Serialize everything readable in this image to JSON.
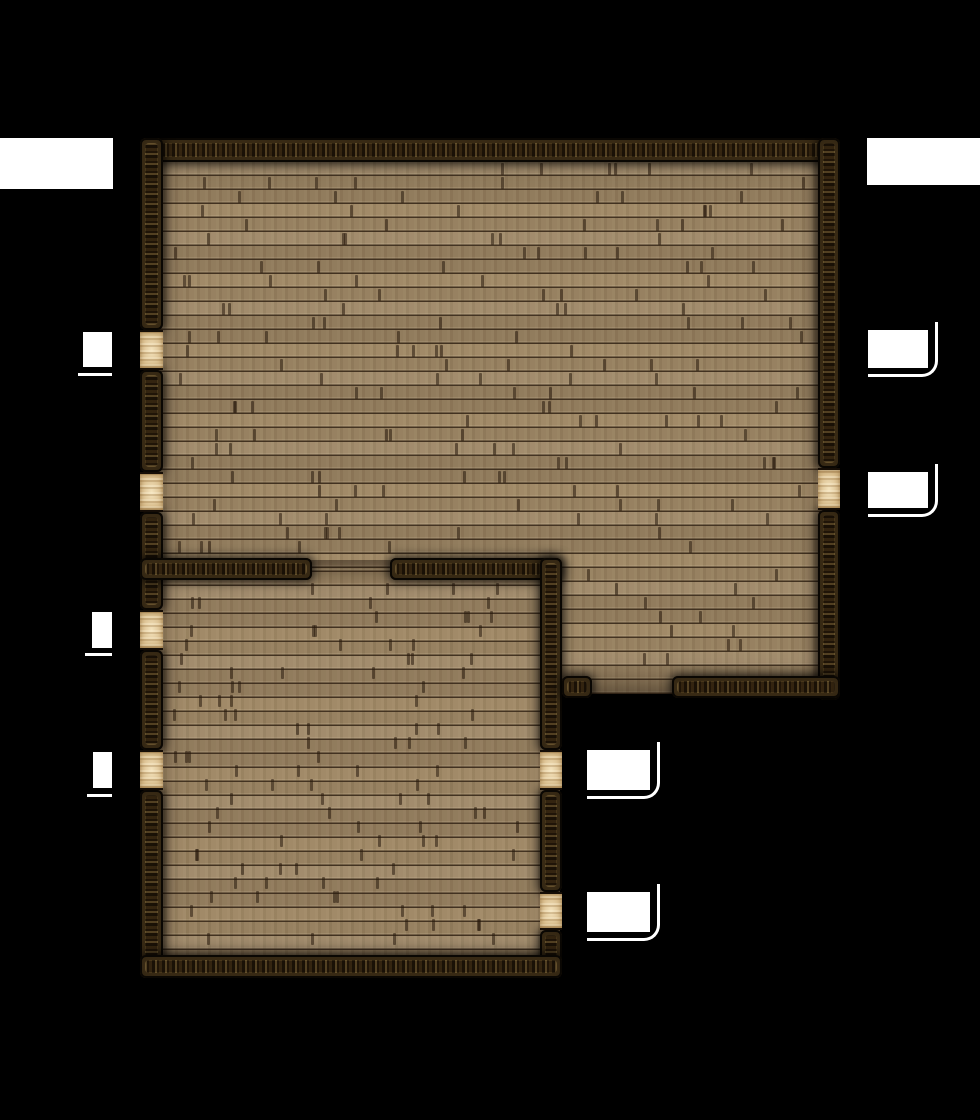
{
  "map": {
    "background_color": "#000000",
    "floor_color": "#9a8361",
    "floor_seam_color": "#342516",
    "wall_color": "#241809",
    "wall_speckle_color": "#dfba6e",
    "door_color": "#e7cfa0",
    "window_color": "#ffffff",
    "plank": {
      "row_height": 14,
      "row_origin": 162,
      "tick_color": "rgba(40,25,12,0.55)",
      "tick_areas": [
        {
          "x": 168,
          "y": 162,
          "w": 644,
          "h": 396
        },
        {
          "x": 566,
          "y": 560,
          "w": 246,
          "h": 114
        },
        {
          "x": 168,
          "y": 580,
          "w": 366,
          "h": 372
        }
      ]
    },
    "floor_areas": [
      {
        "name": "main-hall-floor",
        "x": 150,
        "y": 148,
        "w": 680,
        "h": 546
      },
      {
        "name": "side-room-floor",
        "x": 150,
        "y": 560,
        "w": 410,
        "h": 410
      }
    ],
    "walls": [
      {
        "name": "north-wall",
        "orient": "h",
        "x": 140,
        "y": 138,
        "w": 700,
        "h": 24
      },
      {
        "name": "west-wall-segment-1",
        "orient": "v",
        "x": 140,
        "y": 138,
        "w": 23,
        "h": 192
      },
      {
        "name": "west-wall-segment-2",
        "orient": "v",
        "x": 140,
        "y": 370,
        "w": 23,
        "h": 102
      },
      {
        "name": "west-wall-segment-3",
        "orient": "v",
        "x": 140,
        "y": 512,
        "w": 23,
        "h": 98
      },
      {
        "name": "west-wall-segment-4",
        "orient": "v",
        "x": 140,
        "y": 650,
        "w": 23,
        "h": 100
      },
      {
        "name": "west-wall-segment-5",
        "orient": "v",
        "x": 140,
        "y": 790,
        "w": 23,
        "h": 188
      },
      {
        "name": "east-wall-segment-1",
        "orient": "v",
        "x": 818,
        "y": 138,
        "w": 22,
        "h": 330
      },
      {
        "name": "east-wall-segment-2",
        "orient": "v",
        "x": 818,
        "y": 510,
        "w": 22,
        "h": 190
      },
      {
        "name": "inner-wall-west-segment",
        "orient": "h",
        "x": 140,
        "y": 558,
        "w": 172,
        "h": 22
      },
      {
        "name": "inner-wall-east-segment",
        "orient": "h",
        "x": 390,
        "y": 558,
        "w": 172,
        "h": 22
      },
      {
        "name": "inner-vertical-wall-segment-1",
        "orient": "v",
        "x": 540,
        "y": 558,
        "w": 22,
        "h": 192
      },
      {
        "name": "inner-vertical-wall-segment-2",
        "orient": "v",
        "x": 540,
        "y": 790,
        "w": 22,
        "h": 102
      },
      {
        "name": "inner-vertical-wall-segment-3",
        "orient": "v",
        "x": 540,
        "y": 930,
        "w": 22,
        "h": 48
      },
      {
        "name": "south-wall-stub",
        "orient": "h",
        "x": 562,
        "y": 676,
        "w": 30,
        "h": 22
      },
      {
        "name": "south-wall-east",
        "orient": "h",
        "x": 672,
        "y": 676,
        "w": 168,
        "h": 22
      },
      {
        "name": "south-wall-west-room",
        "orient": "h",
        "x": 140,
        "y": 955,
        "w": 422,
        "h": 23
      }
    ],
    "doors": [
      {
        "name": "west-door-1",
        "x": 140,
        "y": 330,
        "w": 23,
        "h": 40
      },
      {
        "name": "west-door-2",
        "x": 140,
        "y": 472,
        "w": 23,
        "h": 40
      },
      {
        "name": "west-door-3",
        "x": 140,
        "y": 610,
        "w": 23,
        "h": 40
      },
      {
        "name": "west-door-4",
        "x": 140,
        "y": 750,
        "w": 23,
        "h": 40
      },
      {
        "name": "east-door",
        "x": 818,
        "y": 468,
        "w": 22,
        "h": 42
      },
      {
        "name": "inner-door-1",
        "x": 540,
        "y": 750,
        "w": 22,
        "h": 40
      },
      {
        "name": "inner-door-2",
        "x": 540,
        "y": 892,
        "w": 22,
        "h": 38
      }
    ],
    "windows": [
      {
        "name": "window-northwest",
        "x": 0,
        "y": 138,
        "w": 113,
        "h": 51
      },
      {
        "name": "window-northeast",
        "x": 867,
        "y": 138,
        "w": 113,
        "h": 47
      },
      {
        "name": "window-west-1",
        "x": 83,
        "y": 332,
        "w": 29,
        "h": 35,
        "underline": {
          "x": 78,
          "y": 373,
          "w": 34,
          "h": 3
        }
      },
      {
        "name": "window-west-2",
        "x": 92,
        "y": 612,
        "w": 20,
        "h": 36,
        "underline": {
          "x": 85,
          "y": 653,
          "w": 27,
          "h": 3
        }
      },
      {
        "name": "window-west-3",
        "x": 93,
        "y": 752,
        "w": 19,
        "h": 36,
        "underline": {
          "x": 87,
          "y": 794,
          "w": 25,
          "h": 3
        }
      },
      {
        "name": "window-east-1",
        "x": 868,
        "y": 330,
        "w": 60,
        "h": 38,
        "curve": true
      },
      {
        "name": "window-east-2",
        "x": 868,
        "y": 472,
        "w": 60,
        "h": 36,
        "curve": true
      },
      {
        "name": "window-inner-1",
        "x": 587,
        "y": 750,
        "w": 63,
        "h": 40,
        "curve": true
      },
      {
        "name": "window-inner-2",
        "x": 587,
        "y": 892,
        "w": 63,
        "h": 40,
        "curve": true
      }
    ]
  }
}
